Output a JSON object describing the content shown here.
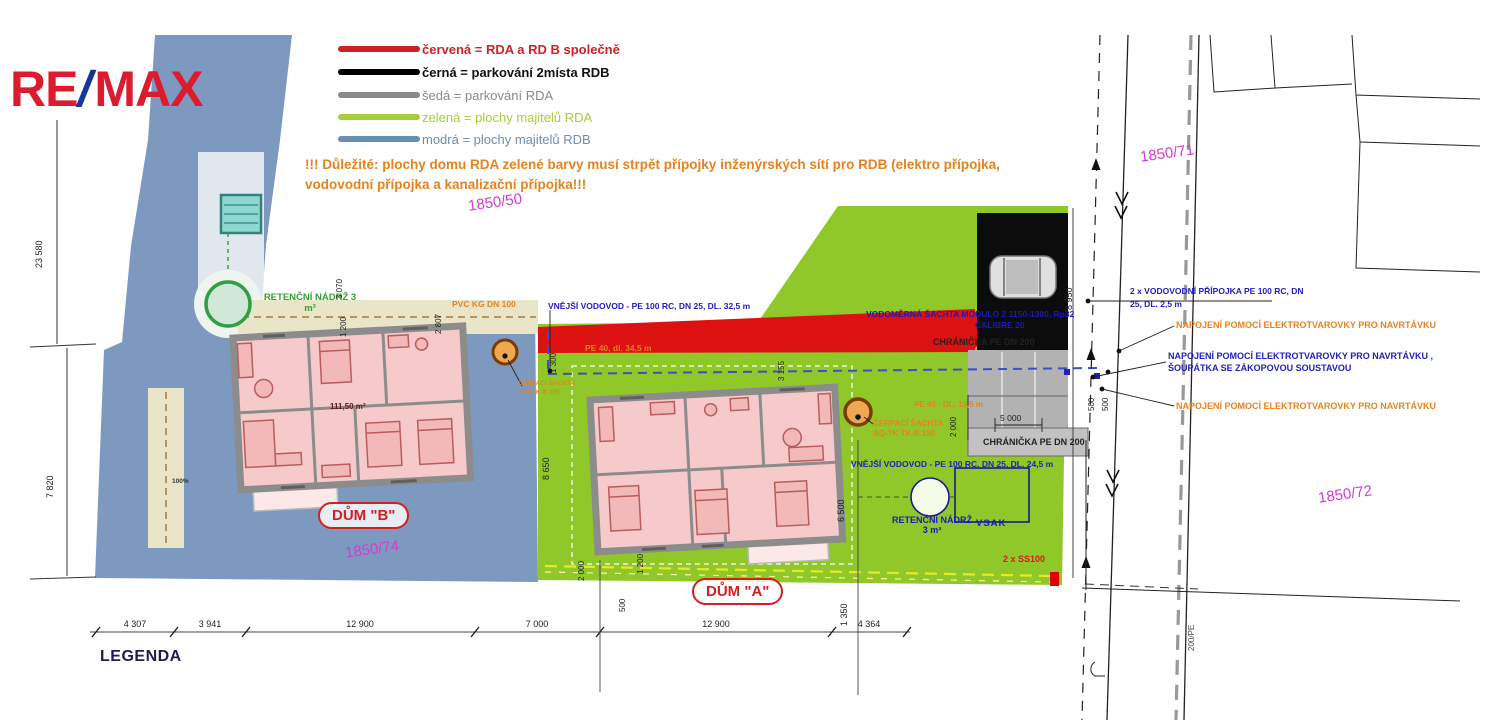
{
  "colors": {
    "blue_parcel": "#7e99bf",
    "green_parcel": "#8fc828",
    "red_band": "#dd1111",
    "black_parking": "#0c0c0c",
    "gray_parking": "#b2b2b2",
    "magenta_parcel_text": "#d23bd2",
    "orange_note": "#e8821e",
    "blue_note": "#2020c0"
  },
  "logo": {
    "re": "RE",
    "slash": "/",
    "max": "MAX"
  },
  "legend": {
    "items": [
      {
        "color": "#cc2229",
        "label": "červená = RDA a RD B společně"
      },
      {
        "color": "#000000",
        "label": "černá = parkování 2místa RDB"
      },
      {
        "color": "#8a8a8a",
        "label": "šedá = parkování RDA"
      },
      {
        "color": "#a6ce39",
        "label": "zelená = plochy majitelů RDA"
      },
      {
        "color": "#6a8fb5",
        "label": "modrá = plochy majitelů RDB"
      }
    ]
  },
  "warning": "!!! Důležité: plochy domu RDA zelené barvy musí strpět přípojky inženýrských sítí pro RDB (elektro přípojka, vodovodní přípojka a kanalizační přípojka!!!",
  "parcels": {
    "p1850_50": "1850/50",
    "p1850_71": "1850/71",
    "p1850_72": "1850/72",
    "p1850_74": "1850/74"
  },
  "houses": {
    "a_label": "DŮM \"A\"",
    "b_label": "DŮM \"B\"",
    "b_area": "111,50 m²",
    "b_pct": "100%"
  },
  "annotations": {
    "retencni_nadrz": "RETENČNÍ NÁDRŽ 3 m³",
    "pvc": "PVC KG DN 100",
    "vodovod_b": "VNĚJŠÍ VODOVOD - PE 100 RC, DN 25, DL. 32,5 m",
    "vodovod_a": "VNĚJŠÍ VODOVOD - PE 100 RC, DN 25, DL. 24,5 m",
    "pe40_long": "PE 40, dl. 34,5 m",
    "pe40_short": "PE 40 - DL. 13,5 m",
    "sachta_b_1": "ČERPACÍ ŠACHTA",
    "sachta_b_2": "AQ-TK-B 150",
    "cerp_sachta_1": "ČERPACÍ ŠACHTA",
    "cerp_sachta_2": "AQ-TK TK-B 150",
    "vodomerna_1": "VODOMĚRNÁ ŠACHTA MODULO 2 1150-1300, Rp32",
    "vodomerna_2": "CALIBRE 20",
    "chranicka": "CHRÁNIČKA PE DN 200",
    "pripojka_1": "2 x VODOVODNÍ PŘÍPOJKA PE 100 RC, DN",
    "pripojka_2": "25, DL. 2,5 m",
    "napojeni_orange": "NAPOJENÍ POMOCÍ ELEKTROTVAROVKY  PRO NAVRTÁVKU",
    "napojeni_blue_1": "NAPOJENÍ POMOCÍ ELEKTROTVAROVKY  PRO NAVRTÁVKU ,",
    "napojeni_blue_2": "ŠOUPÁTKA SE ZÁKOPOVOU SOUSTAVOU",
    "vsak": "VSAK",
    "ss100": "2 x SS100",
    "road_pipe": "200/PE"
  },
  "dimensions": {
    "bottom": [
      "4 307",
      "3 941",
      "12 900",
      "7 000",
      "12 900",
      "4 364"
    ],
    "d23580": "23 580",
    "d7820": "7 820",
    "d3070": "3 070",
    "d1200b": "1 200",
    "d2807": "2 807",
    "d1300": "1 300",
    "d8650": "8 650",
    "d3155": "3 155",
    "d8950": "8 950",
    "d2000a": "2 000",
    "d5000": "5 000",
    "d6500": "6 500",
    "d1350": "1 350",
    "d2000b": "2 000",
    "d500b": "500",
    "d1200a": "1 200",
    "d500r1": "500",
    "d500r2": "500"
  },
  "legend_title": "LEGENDA"
}
